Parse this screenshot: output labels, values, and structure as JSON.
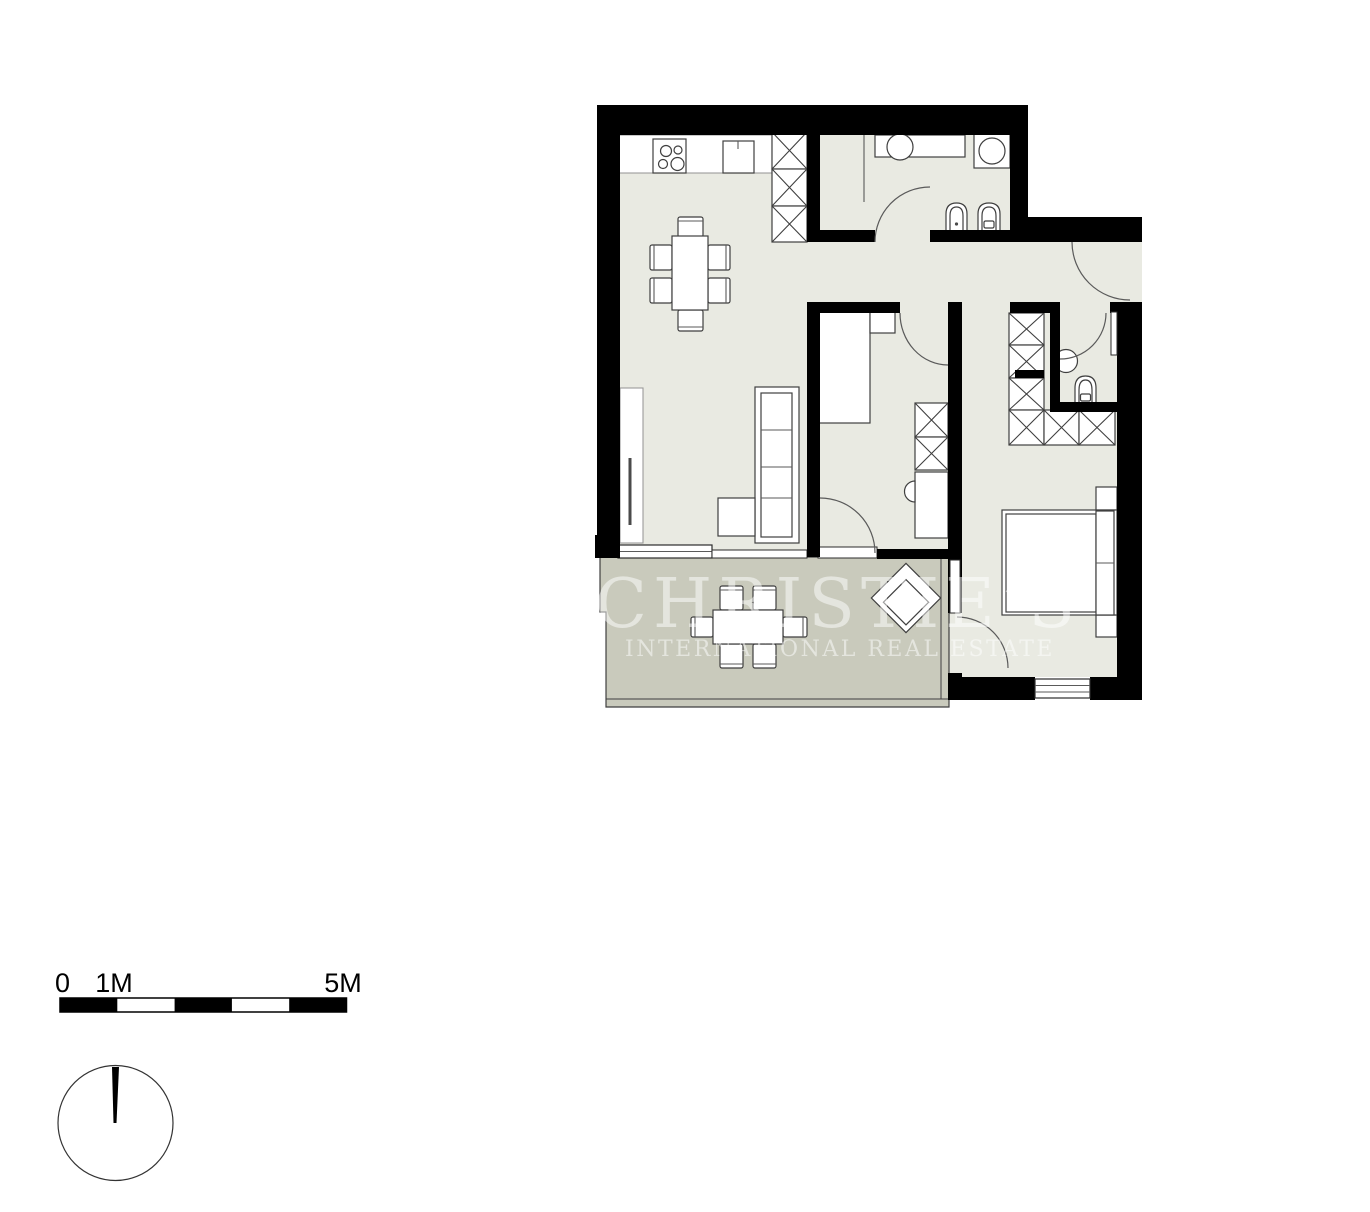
{
  "watermark": {
    "line1": "CHRISTIE’S",
    "line2": "INTERNATIONAL REAL ESTATE"
  },
  "scale_bar": {
    "label_start": "0",
    "label_1m": "1M",
    "label_5m": "5M"
  },
  "colors": {
    "wall": "#000000",
    "interior": "#e9eae2",
    "terrace": "#c9cabc",
    "stroke": "#3f3f3f",
    "lightstroke": "#9a9a9a",
    "arc": "#5a5a5a",
    "watermark": "#ffffff",
    "text": "#000000"
  }
}
